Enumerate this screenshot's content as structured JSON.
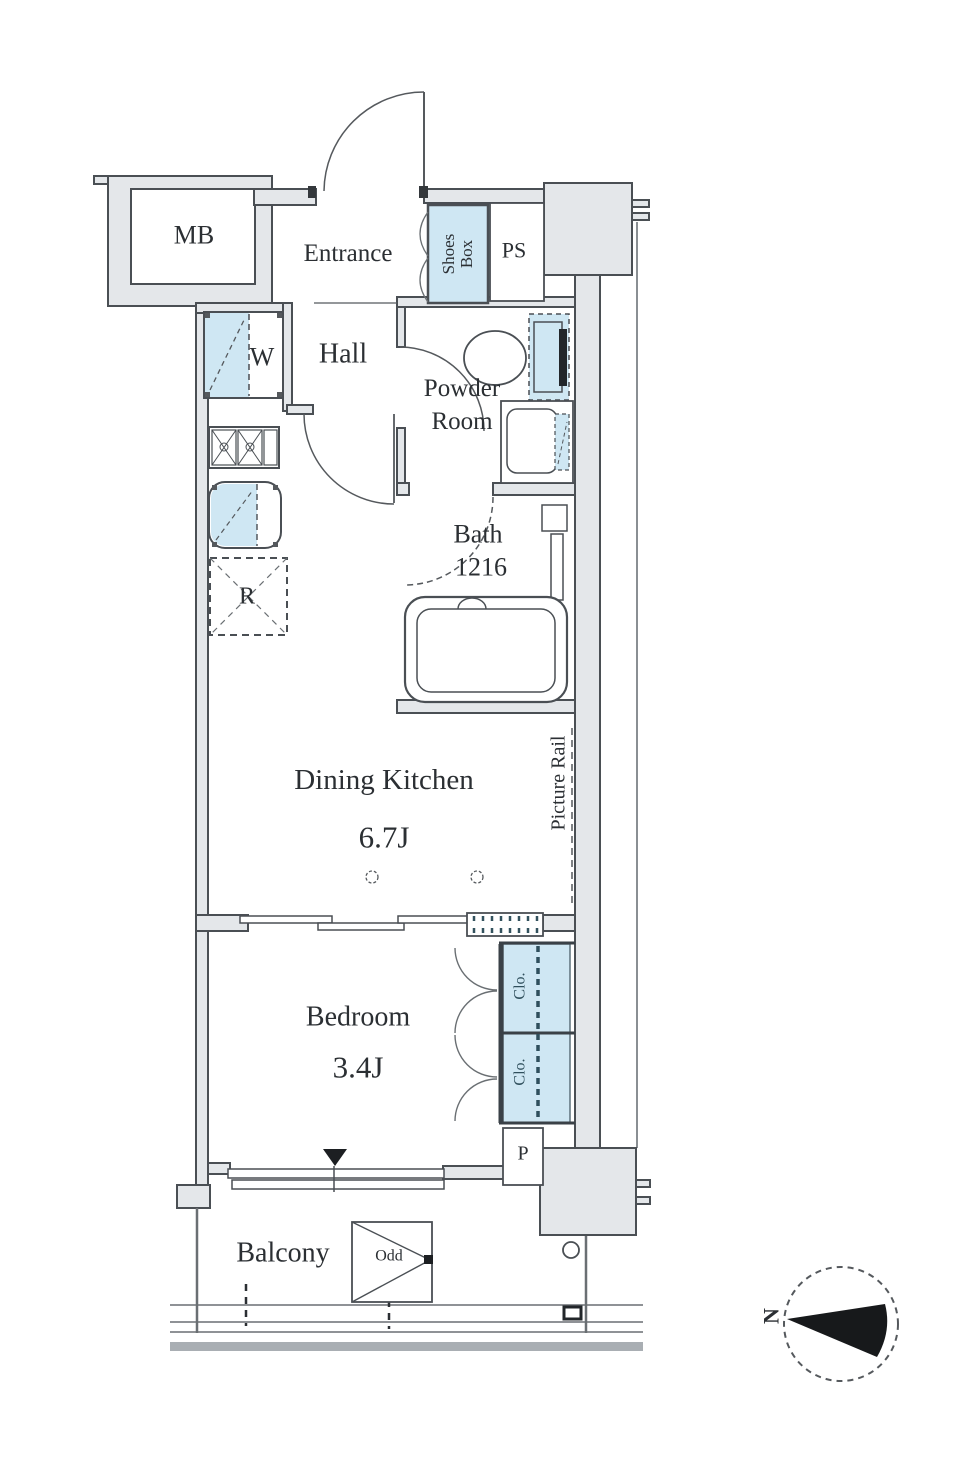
{
  "floorplan": {
    "labels": {
      "mb": "MB",
      "entrance": "Entrance",
      "shoes_box_line1": "Shoes",
      "shoes_box_line2": "Box",
      "ps": "PS",
      "washer": "W",
      "hall": "Hall",
      "powder_line1": "Powder",
      "powder_line2": "Room",
      "bath": "Bath",
      "bath_size": "1216",
      "fridge": "R",
      "dining_kitchen": "Dining Kitchen",
      "dining_kitchen_size": "6.7J",
      "picture_rail": "Picture Rail",
      "bedroom": "Bedroom",
      "bedroom_size": "3.4J",
      "closet_upper": "Clo.",
      "closet_lower": "Clo.",
      "pipe_space": "P",
      "balcony": "Balcony",
      "floor_indicator": "Odd",
      "compass_north": "N"
    },
    "colors": {
      "fixture_blue": "#cfe7f3",
      "wall_gray": "#e4e7ea",
      "line_dark": "#4a4f54"
    }
  }
}
